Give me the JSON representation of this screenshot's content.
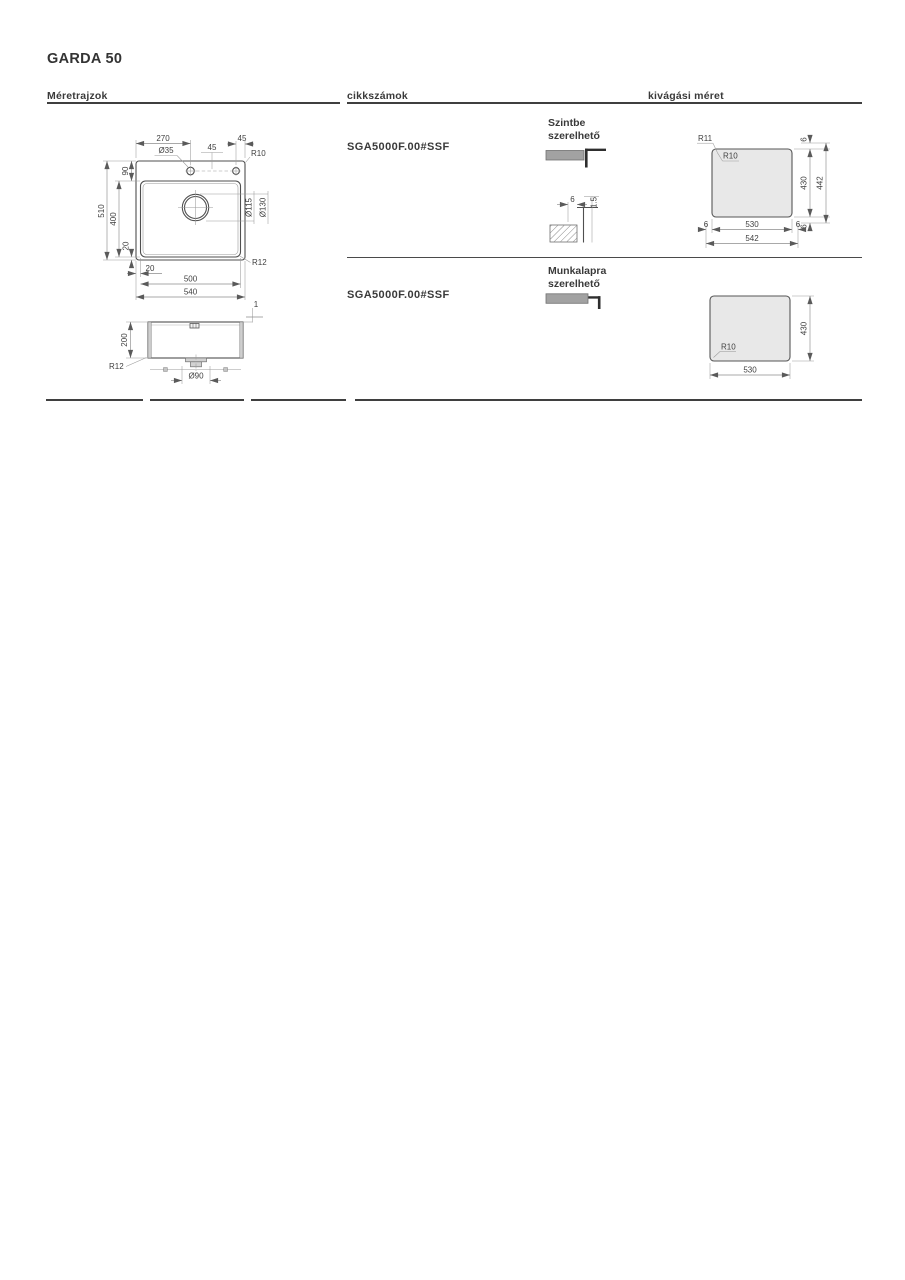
{
  "title": "GARDA 50",
  "headers": {
    "drawings": "Méretrajzok",
    "articles": "cikkszámok",
    "cutout": "kivágási méret"
  },
  "rows": [
    {
      "article": "SGA5000F.00#SSF",
      "mount_line1": "Szintbe",
      "mount_line2": "szerelhető"
    },
    {
      "article": "SGA5000F.00#SSF",
      "mount_line1": "Munkalapra",
      "mount_line2": "szerelhető"
    }
  ],
  "top_view": {
    "total_width": "540",
    "bowl_width": "500",
    "bowl_offset": "20",
    "total_depth": "510",
    "bowl_depth": "400",
    "rim_top": "90",
    "rim_bottom": "20",
    "tap_hole_pos": "270",
    "tap_hole_dia": "Ø35",
    "hole_gap": "45",
    "hole_edge": "45",
    "outer_radius": "R10",
    "bowl_radius": "R12",
    "drain_dia_inner": "Ø115",
    "drain_dia_outer": "Ø130"
  },
  "section_view": {
    "depth": "200",
    "drain_dia": "Ø90",
    "corner_radius": "R12",
    "rim_height": "1"
  },
  "flush_detail": {
    "recess_width": "6",
    "recess_depth": "1.5"
  },
  "cutout_flush": {
    "corner_outer": "R11",
    "corner_inner": "R10",
    "width": "530",
    "width_outer": "542",
    "height": "430",
    "height_outer": "442",
    "recess": "6"
  },
  "cutout_top": {
    "corner": "R10",
    "width": "530",
    "height": "430"
  },
  "colors": {
    "drawing_fill": "#e7e7e7",
    "drawing_line": "#4f4f4f",
    "dimension_line": "#8c8c8c",
    "text": "#3a3a3a",
    "rule": "#3f3f3f",
    "icon_gray": "#a2a2a2",
    "icon_black": "#2e2e2e"
  }
}
